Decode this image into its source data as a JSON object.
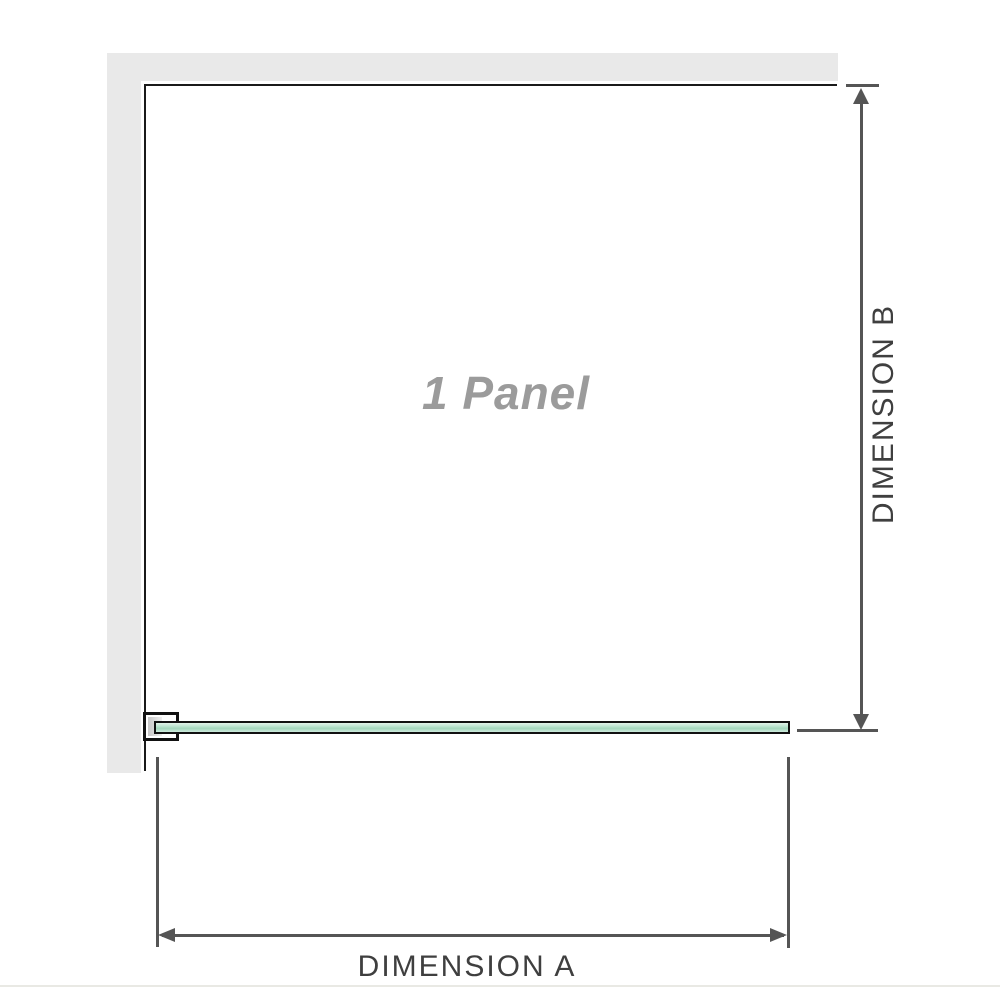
{
  "diagram": {
    "panel_label": "1 Panel",
    "dimension_a_label": "DIMENSION A",
    "dimension_b_label": "DIMENSION B",
    "colors": {
      "wall_gray": "#e9e9e9",
      "outline_black": "#1a1a1a",
      "dimension_line_gray": "#555555",
      "dimension_label_gray": "#3f3f3f",
      "panel_label_gray": "#9b9b9b",
      "glass_green_mid": "#a3d6bc",
      "glass_green_light": "#e2f3e9",
      "baseline_gray": "#e9e9e4"
    }
  }
}
